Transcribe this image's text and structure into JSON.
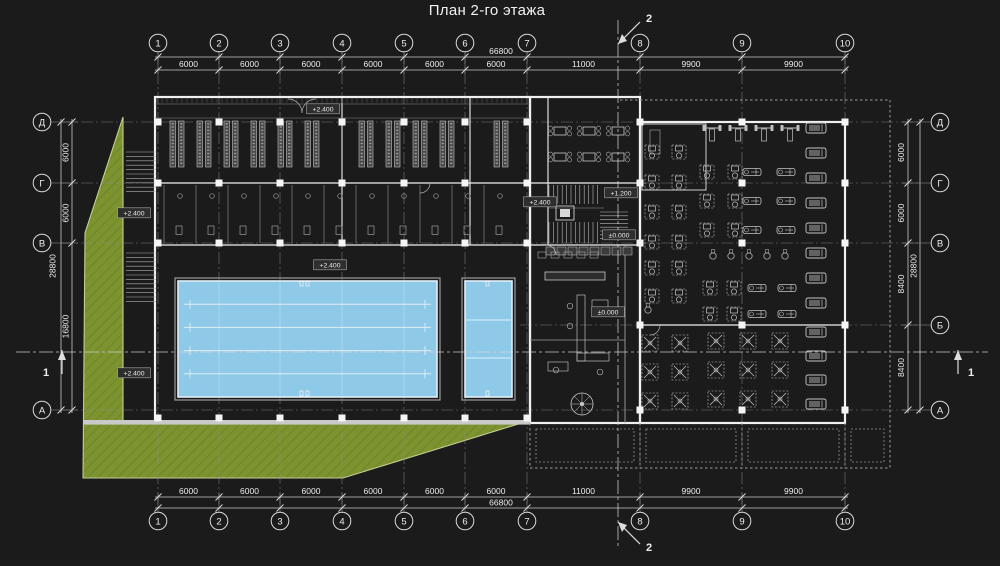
{
  "title": "План 2-го этажа",
  "colors": {
    "background": "#1b1b1c",
    "line": "#e8e8e8",
    "dim_line": "#c9c9c9",
    "grid_line": "#8f8f8f",
    "wall": "#f0f0f0",
    "detail": "#b5b5b5",
    "green": "#7d9330",
    "green_edge": "#c3cf93",
    "pool": "#8ec9e8",
    "pool_edge": "#e2eef6",
    "column": "#f5f5f5",
    "label": "#ededed",
    "equipment": "#c5c5c5"
  },
  "grid": {
    "cols": [
      {
        "label": "1",
        "x": 158
      },
      {
        "label": "2",
        "x": 219
      },
      {
        "label": "3",
        "x": 280
      },
      {
        "label": "4",
        "x": 342
      },
      {
        "label": "5",
        "x": 404
      },
      {
        "label": "6",
        "x": 465
      },
      {
        "label": "7",
        "x": 527
      },
      {
        "label": "8",
        "x": 640
      },
      {
        "label": "9",
        "x": 742
      },
      {
        "label": "10",
        "x": 845
      }
    ],
    "rows": [
      {
        "label": "Д",
        "y": 122,
        "sides": "both"
      },
      {
        "label": "Г",
        "y": 183,
        "sides": "both"
      },
      {
        "label": "В",
        "y": 243,
        "sides": "both"
      },
      {
        "label": "Б",
        "y": 325,
        "sides": "right"
      },
      {
        "label": "А",
        "y": 410,
        "sides": "both"
      }
    ]
  },
  "dims": {
    "top_segments": [
      "6000",
      "6000",
      "6000",
      "6000",
      "6000",
      "6000",
      "11000",
      "9900",
      "9900"
    ],
    "top_total": "66800",
    "bottom_segments": [
      "6000",
      "6000",
      "6000",
      "6000",
      "6000",
      "6000",
      "11000",
      "9900",
      "9900"
    ],
    "bottom_total": "66800",
    "left_segments": [
      {
        "label": "6000",
        "a": 122,
        "b": 183
      },
      {
        "label": "6000",
        "a": 183,
        "b": 243
      },
      {
        "label": "16800",
        "a": 243,
        "b": 410
      }
    ],
    "left_total": "28800",
    "right_segments": [
      {
        "label": "6000",
        "a": 122,
        "b": 183
      },
      {
        "label": "6000",
        "a": 183,
        "b": 243
      },
      {
        "label": "8400",
        "a": 243,
        "b": 325
      },
      {
        "label": "8400",
        "a": 325,
        "b": 410
      }
    ],
    "right_total": "28800"
  },
  "sections": {
    "vertical_label": "2",
    "horizontal_label": "1"
  },
  "elevations": [
    {
      "text": "+2.400",
      "x": 323,
      "y": 109
    },
    {
      "text": "+2.400",
      "x": 134,
      "y": 213
    },
    {
      "text": "+2.400",
      "x": 134,
      "y": 373
    },
    {
      "text": "+2.400",
      "x": 540,
      "y": 202
    },
    {
      "text": "+2.400",
      "x": 330,
      "y": 265
    },
    {
      "text": "+1.200",
      "x": 621,
      "y": 193
    },
    {
      "text": "±0.000",
      "x": 619,
      "y": 235
    },
    {
      "text": "±0.000",
      "x": 608,
      "y": 312
    }
  ],
  "lockers": {
    "pairs_x": [
      170,
      197,
      224,
      251,
      278,
      305,
      359,
      386,
      413,
      440,
      494
    ],
    "y": 121,
    "height": 46
  },
  "shower_partitions_x": [
    164,
    196,
    228,
    260,
    292,
    324,
    356,
    388,
    420,
    452,
    484
  ],
  "cafe": {
    "x": 560,
    "y": 131,
    "cols": 3,
    "rows": 2,
    "dx": 29,
    "dy": 26
  },
  "pool": {
    "lanes": 5,
    "x": 178,
    "y": 281,
    "w": 259,
    "h": 116
  },
  "small_pool": {
    "x": 465,
    "y": 281,
    "w": 47,
    "h": 116
  },
  "equipment": [
    {
      "type": "station",
      "name": "weight-station",
      "x": 712,
      "y": 133,
      "cols": 4,
      "rows": 1,
      "dx": 26,
      "dy": 0
    },
    {
      "type": "mach",
      "name": "strength-machine",
      "x": 652,
      "y": 152,
      "cols": 2,
      "rows": 4,
      "dx": 27,
      "dy": 30
    },
    {
      "type": "mach",
      "name": "strength-machine",
      "x": 707,
      "y": 172,
      "cols": 2,
      "rows": 3,
      "dx": 28,
      "dy": 29
    },
    {
      "type": "row",
      "name": "rowing-machine",
      "x": 752,
      "y": 172,
      "cols": 2,
      "rows": 3,
      "dx": 34,
      "dy": 29
    },
    {
      "type": "tread",
      "name": "treadmill",
      "x": 816,
      "y": 128,
      "cols": 1,
      "rows": 8,
      "dx": 0,
      "dy": 25
    },
    {
      "type": "small",
      "name": "spin-bike",
      "x": 713,
      "y": 256,
      "cols": 5,
      "rows": 1,
      "dx": 18,
      "dy": 0
    },
    {
      "type": "mach",
      "name": "strength-machine",
      "x": 652,
      "y": 268,
      "cols": 2,
      "rows": 2,
      "dx": 27,
      "dy": 28
    },
    {
      "type": "mach",
      "name": "strength-machine",
      "x": 710,
      "y": 288,
      "cols": 2,
      "rows": 2,
      "dx": 24,
      "dy": 26
    },
    {
      "type": "row",
      "name": "rowing-machine",
      "x": 757,
      "y": 288,
      "cols": 2,
      "rows": 2,
      "dx": 30,
      "dy": 26
    },
    {
      "type": "cross",
      "name": "cable-crossover",
      "x": 650,
      "y": 343,
      "cols": 2,
      "rows": 3,
      "dx": 30,
      "dy": 29
    },
    {
      "type": "cross",
      "name": "cable-crossover",
      "x": 716,
      "y": 341,
      "cols": 3,
      "rows": 3,
      "dx": 32,
      "dy": 29
    },
    {
      "type": "tread",
      "name": "treadmill",
      "x": 816,
      "y": 332,
      "cols": 1,
      "rows": 4,
      "dx": 0,
      "dy": 24
    },
    {
      "type": "small",
      "name": "spin-bike",
      "x": 648,
      "y": 310,
      "cols": 1,
      "rows": 1,
      "dx": 0,
      "dy": 0
    }
  ]
}
